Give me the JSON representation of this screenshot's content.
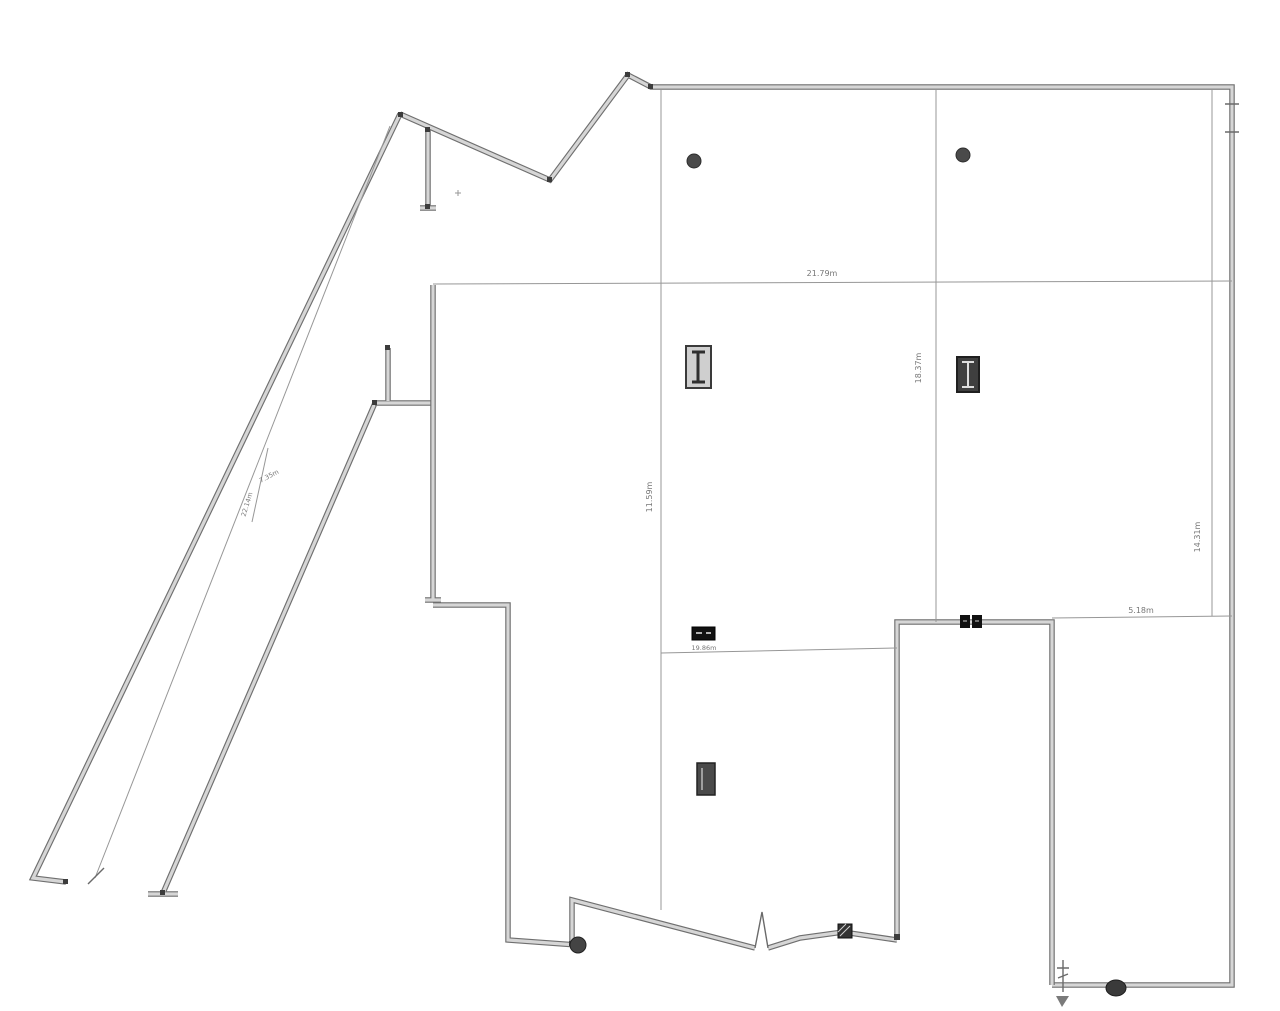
{
  "drawing": {
    "kind": "architectural floor plan",
    "background_color": "#ffffff",
    "wall_edge_color": "#6f6f6f",
    "wall_core_color": "#d6d6d6",
    "line_color": "#979797",
    "text_color": "#777777"
  },
  "dimensions": {
    "top_width": {
      "value": "21.79m"
    },
    "right_bay_height": {
      "value": "18.37m"
    },
    "center_bay_height": {
      "value": "11.59m"
    },
    "lower_hall_width": {
      "value": "19.86m"
    },
    "right_lower_width": {
      "value": "5.18m"
    },
    "far_right_height": {
      "value": "14.31m"
    },
    "diagonal_length": {
      "value": "22.14m"
    },
    "diagonal_clear_width": {
      "value": "7.35m"
    }
  },
  "symbols": {
    "round_column_1": "round structural column",
    "round_column_2": "round structural column",
    "ibeam_column_1": "I-beam steel column",
    "ibeam_column_2": "I-beam steel column",
    "filled_column": "rectangular column",
    "tag_box": "small black label tag",
    "double_socket": "twin black wall symbol",
    "door_jamb": "hatched door jamb block",
    "corner_column_left": "round corner column",
    "corner_column_right": "round corner column",
    "wall_break": "wall break zigzag symbol",
    "level_marker": "level / datum marker"
  }
}
